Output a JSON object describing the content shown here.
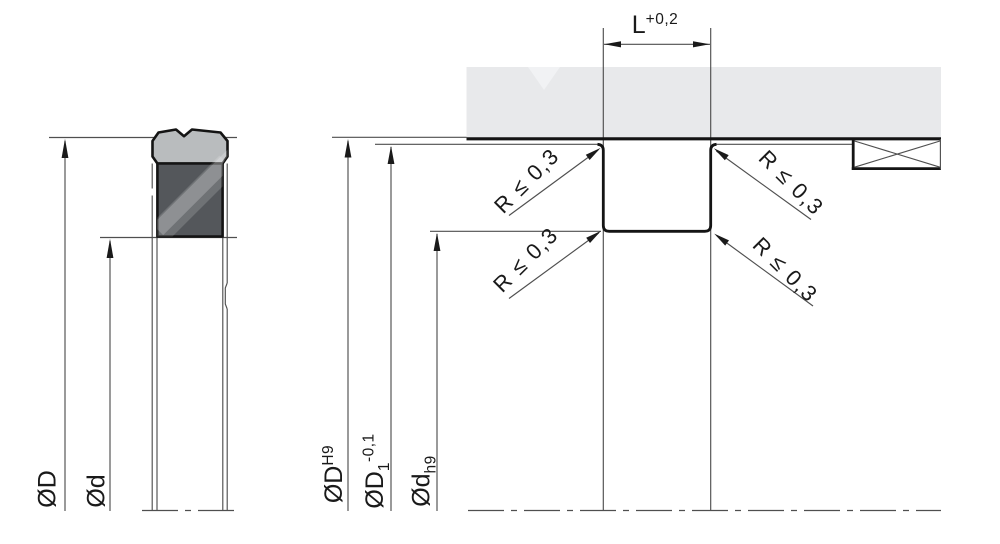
{
  "drawing": {
    "left_view": {
      "outer_diameter": "ØD",
      "inner_diameter": "Ød"
    },
    "right_view": {
      "groove_width": {
        "base": "L",
        "tolerance_sup": "+0,2"
      },
      "bore_diameter": {
        "base": "ØD",
        "fit_sup": "H9"
      },
      "counterbore_diameter": {
        "base": "ØD",
        "index_sub": "1",
        "tolerance_sup": "-0,1"
      },
      "rod_diameter": {
        "base": "Ød",
        "fit_sub": "h9"
      },
      "corner_radius_notes": [
        "R ≤ 0,3",
        "R ≤ 0,3",
        "R ≤ 0,3",
        "R ≤ 0,3"
      ]
    },
    "colors": {
      "housing_fill": "#e8e9eb",
      "housing_watermark": "#f1f2f4",
      "seal_cap_fill": "#b9bcbe",
      "seal_body_fill": "#54575b",
      "outline": "#141414",
      "thin_line": "#4f4f4f"
    }
  }
}
